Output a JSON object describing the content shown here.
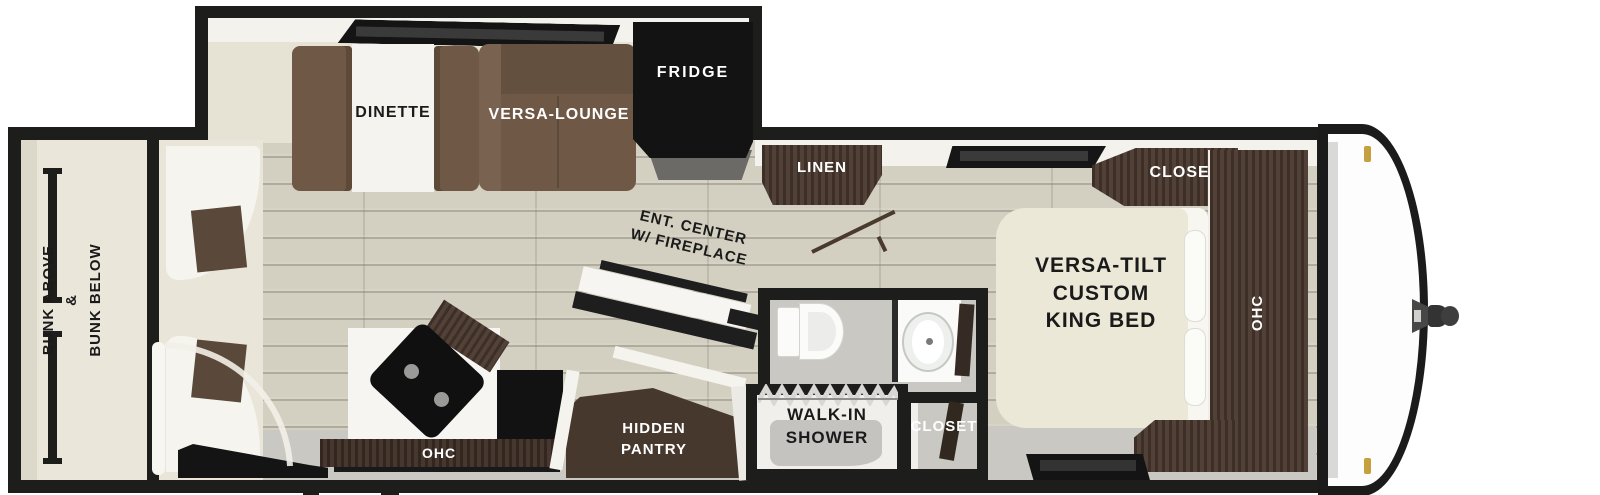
{
  "labels": {
    "bunk": {
      "l1": "BUNK ABOVE",
      "l2": "&",
      "l3": "BUNK BELOW"
    },
    "dinette": "DINETTE",
    "versa_lounge": "VERSA-LOUNGE",
    "fridge": "FRIDGE",
    "linen": "LINEN",
    "ent_center": {
      "l1": "ENT. CENTER",
      "l2": "W/ FIREPLACE"
    },
    "kitchen_ohc": "OHC",
    "pantry": {
      "l1": "HIDDEN",
      "l2": "PANTRY"
    },
    "shower": {
      "l1": "WALK-IN",
      "l2": "SHOWER"
    },
    "bath_closet": "CLOSET",
    "bed": {
      "l1": "VERSA-TILT",
      "l2": "CUSTOM",
      "l3": "KING BED"
    },
    "bedroom_closet": "CLOSET",
    "bedroom_ohc": "OHC"
  },
  "colors": {
    "wall": "#1d1d1b",
    "cabinet_wood": "#4a392f",
    "sofa_brown": "#6f5845",
    "floor_plank": "#d3cfc1",
    "bed_cream": "#ebe8d8",
    "marker_gold": "#c5a03e",
    "label_light": "#ffffff",
    "label_dark": "#1a1a1a"
  }
}
